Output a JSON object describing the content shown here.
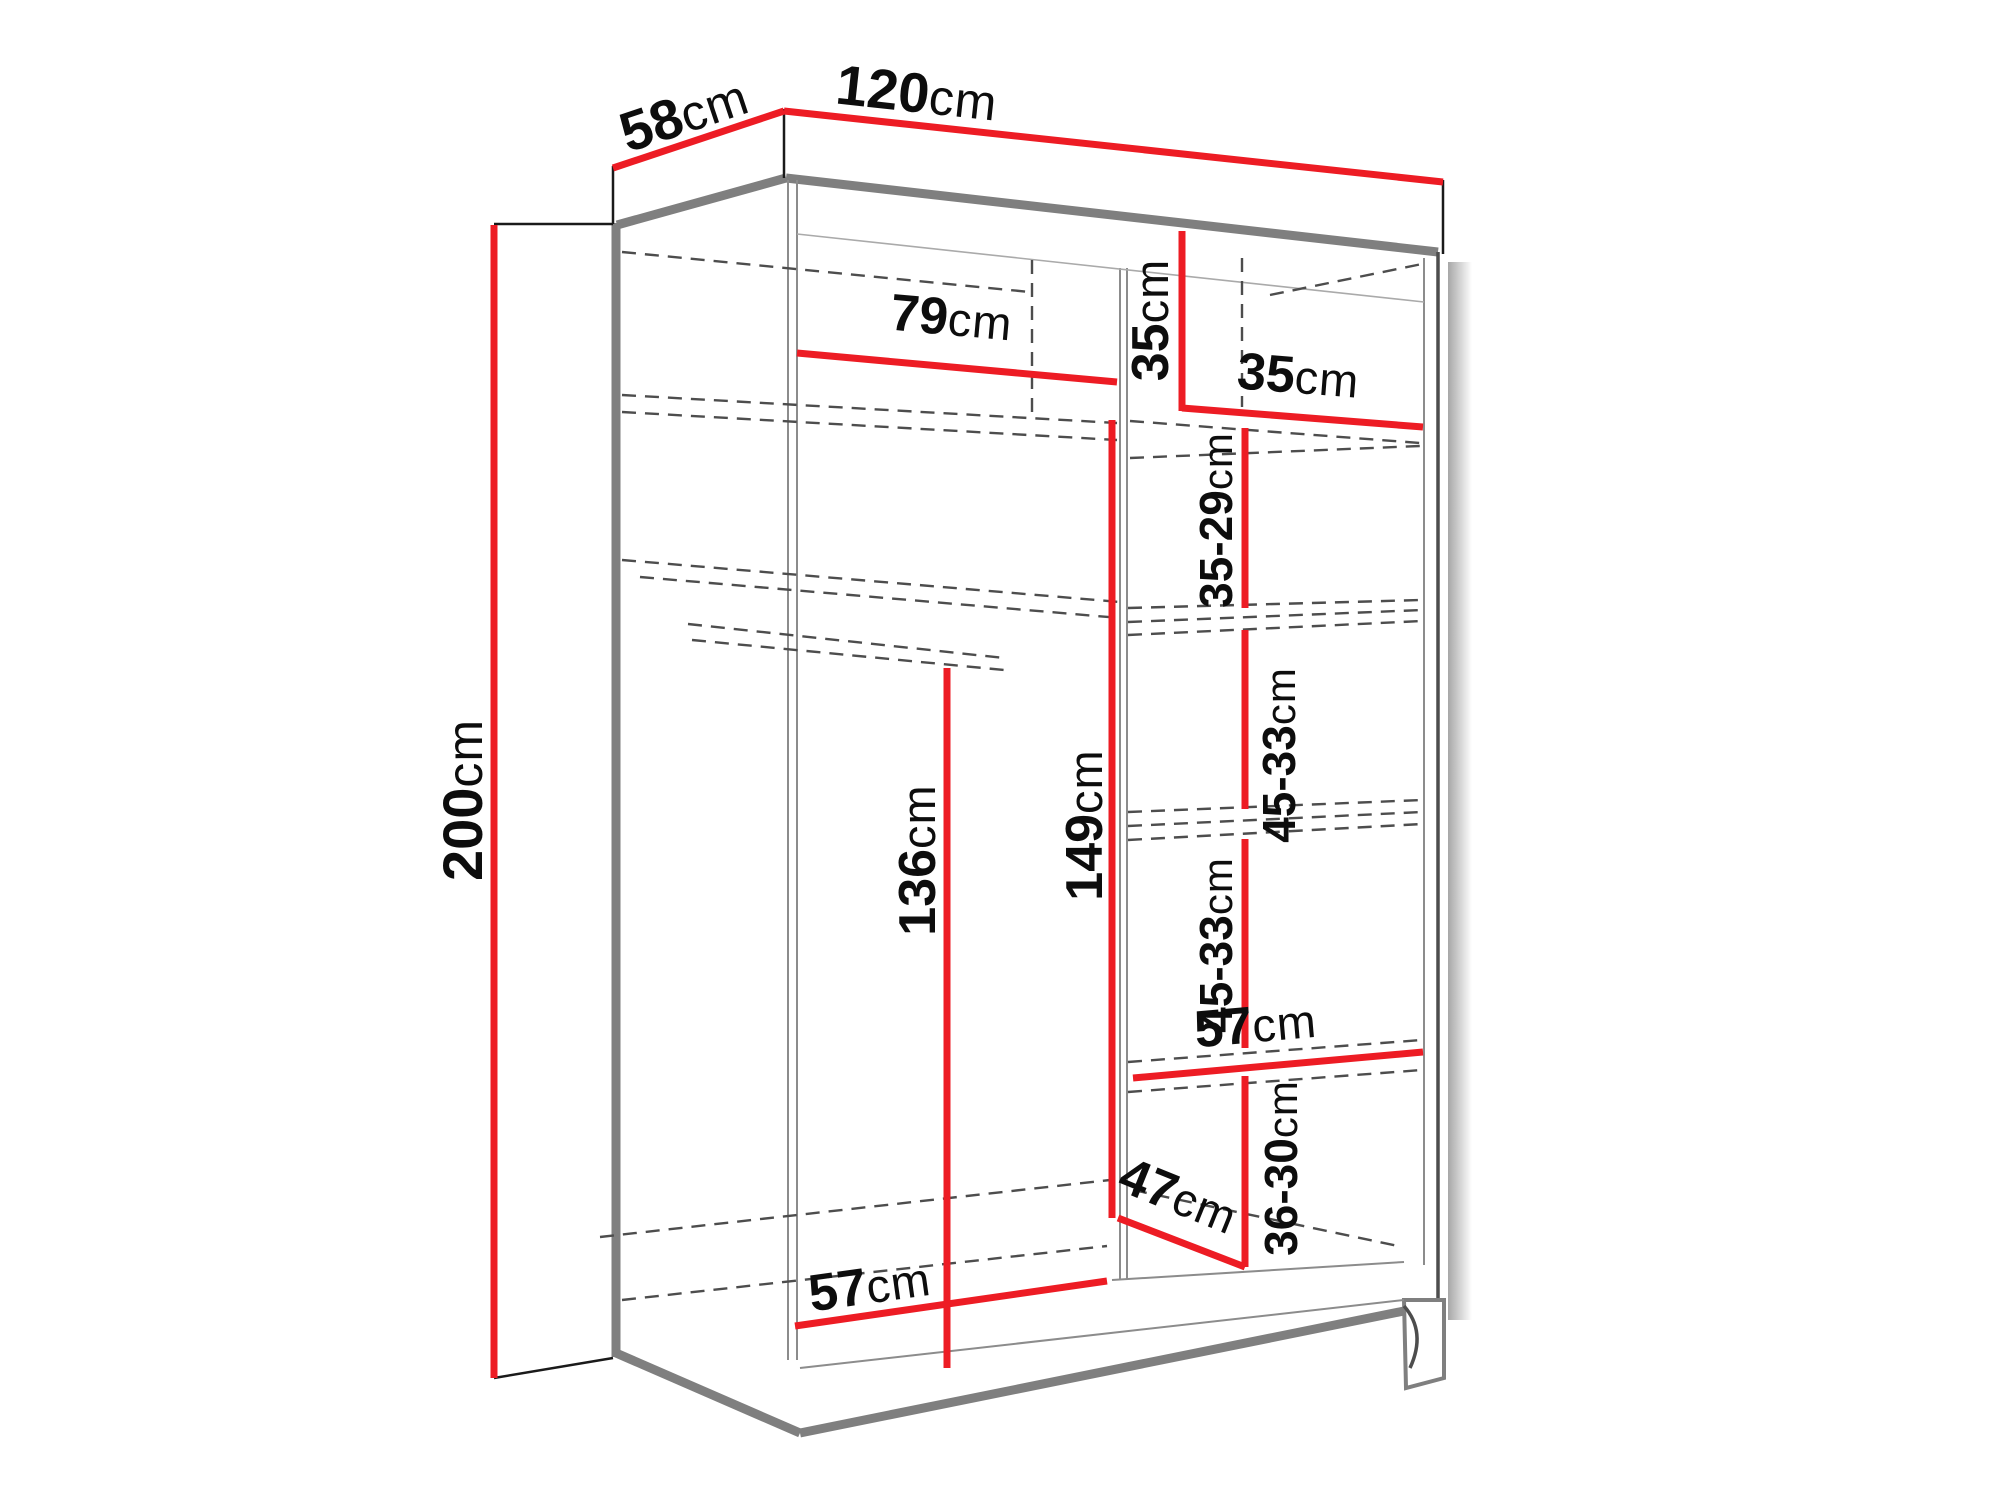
{
  "diagram": {
    "kind": "wardrobe-dimension-drawing",
    "unit": "cm"
  },
  "labels": {
    "depth_top": {
      "num": "58",
      "unit": "cm"
    },
    "width_top": {
      "num": "120",
      "unit": "cm"
    },
    "height_left": {
      "num": "200",
      "unit": "cm"
    },
    "hang_width_left": {
      "num": "79",
      "unit": "cm"
    },
    "cubby_height_right": {
      "num": "35",
      "unit": "cm"
    },
    "cubby_width_right": {
      "num": "35",
      "unit": "cm"
    },
    "shelf_gap_1": {
      "num": "35-29",
      "unit": "cm"
    },
    "shelf_gap_2": {
      "num": "45-33",
      "unit": "cm"
    },
    "shelf_gap_3": {
      "num": "45-33",
      "unit": "cm"
    },
    "shelf_gap_4": {
      "num": "36-30",
      "unit": "cm"
    },
    "hang_height_left": {
      "num": "136",
      "unit": "cm"
    },
    "hang_height_mid": {
      "num": "149",
      "unit": "cm"
    },
    "shelf_width_right": {
      "num": "57",
      "unit": "cm"
    },
    "shelf_depth_right": {
      "num": "47",
      "unit": "cm"
    },
    "floor_width_left": {
      "num": "57",
      "unit": "cm"
    }
  },
  "colors": {
    "dimension_red": "#ed1c24",
    "edge_gray": "#7f7f7f",
    "dashed_gray": "#4d4d4d",
    "label_black": "#0d0d0d",
    "background": "#ffffff"
  }
}
